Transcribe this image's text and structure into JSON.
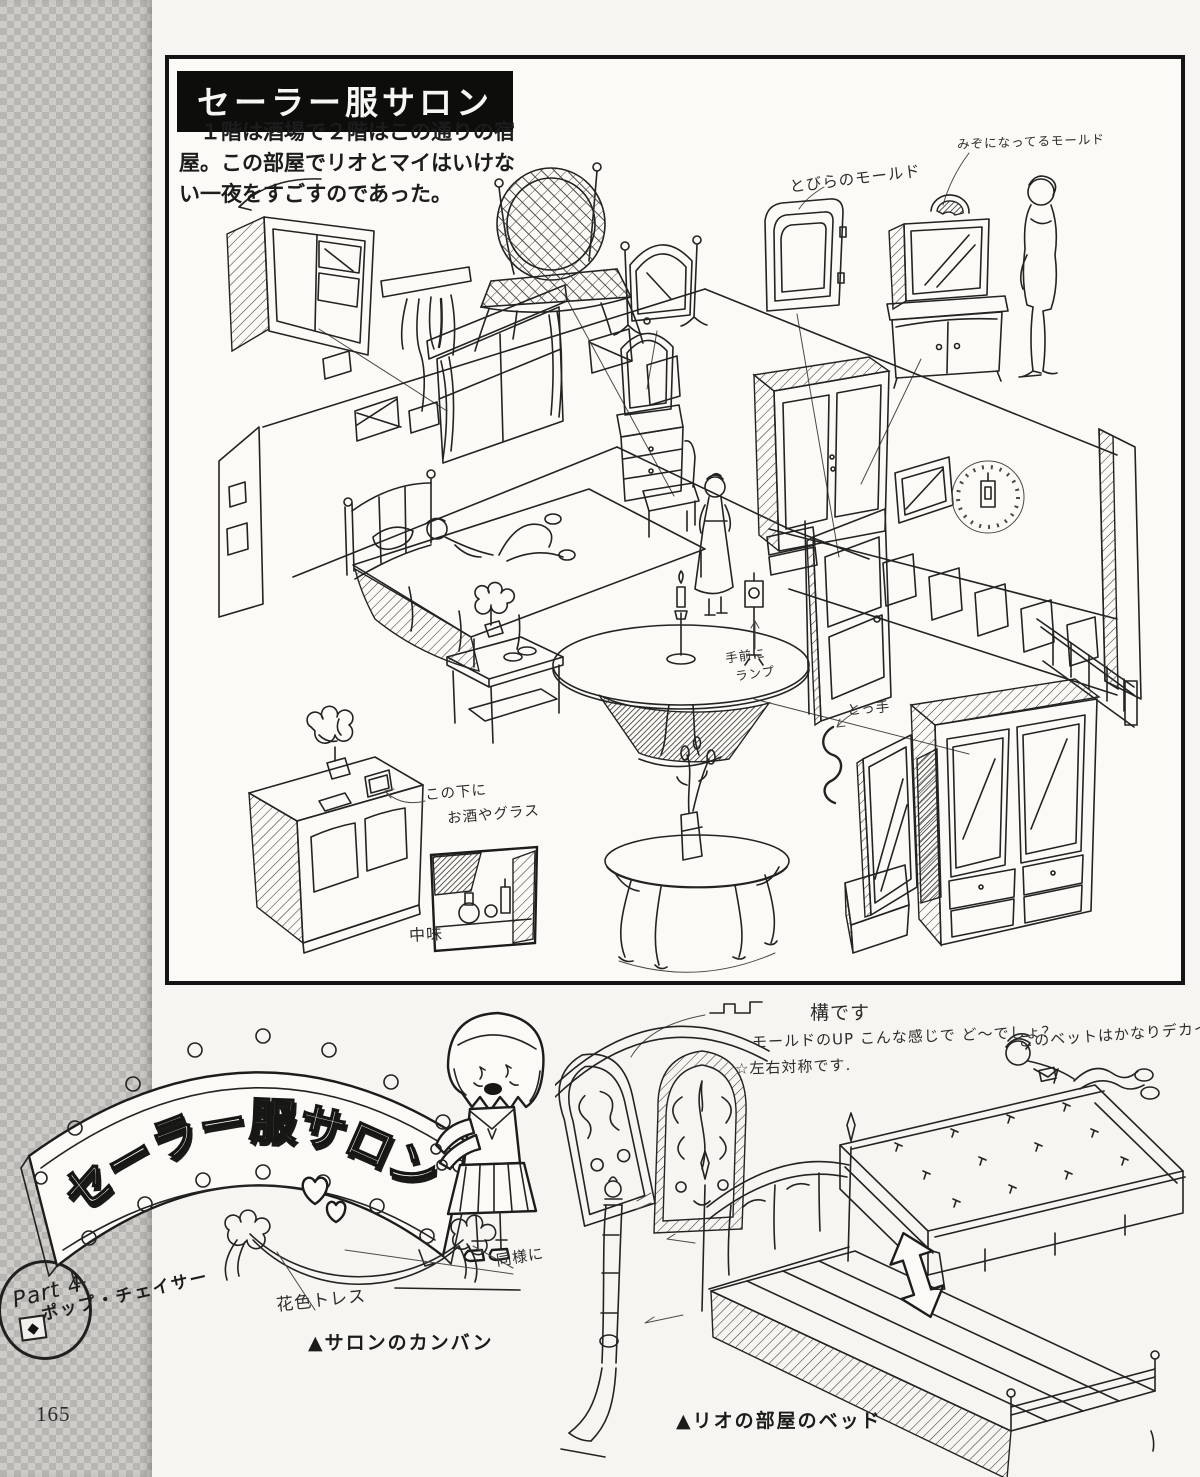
{
  "page": {
    "number": "165",
    "part_label": "Part 4",
    "part_diamond": "◆",
    "series_label": "ポップ・チェイサー"
  },
  "header": {
    "title": "セーラー服サロン",
    "description": "１階は酒場で２階はこの通りの宿屋。この部屋でリオとマイはいけない一夜をすごすのであった。"
  },
  "room": {
    "annotations": {
      "groove_molding": "みぞになってるモールド",
      "door_molding": "とびらのモールド",
      "front_lamp_line1": "手前に",
      "front_lamp_line2": "ランプ",
      "handle": "とっ手",
      "under_here_line1": "この下に",
      "under_here_line2": "お酒やグラス",
      "contents": "中味"
    }
  },
  "sign": {
    "banner_text": "セーラー服サロン",
    "garland_label": "花色トレス",
    "same_as_label": "同様に",
    "caption": "▲サロンのカンバン"
  },
  "bed": {
    "structure_label": "構です",
    "molding_note": "モールドのUP こんな感じで ど〜でしょ？",
    "symmetry_note": "☆左右対称です.",
    "size_note": "このベットはかなりデカイ",
    "caption": "▲リオの部屋のベッド"
  }
}
